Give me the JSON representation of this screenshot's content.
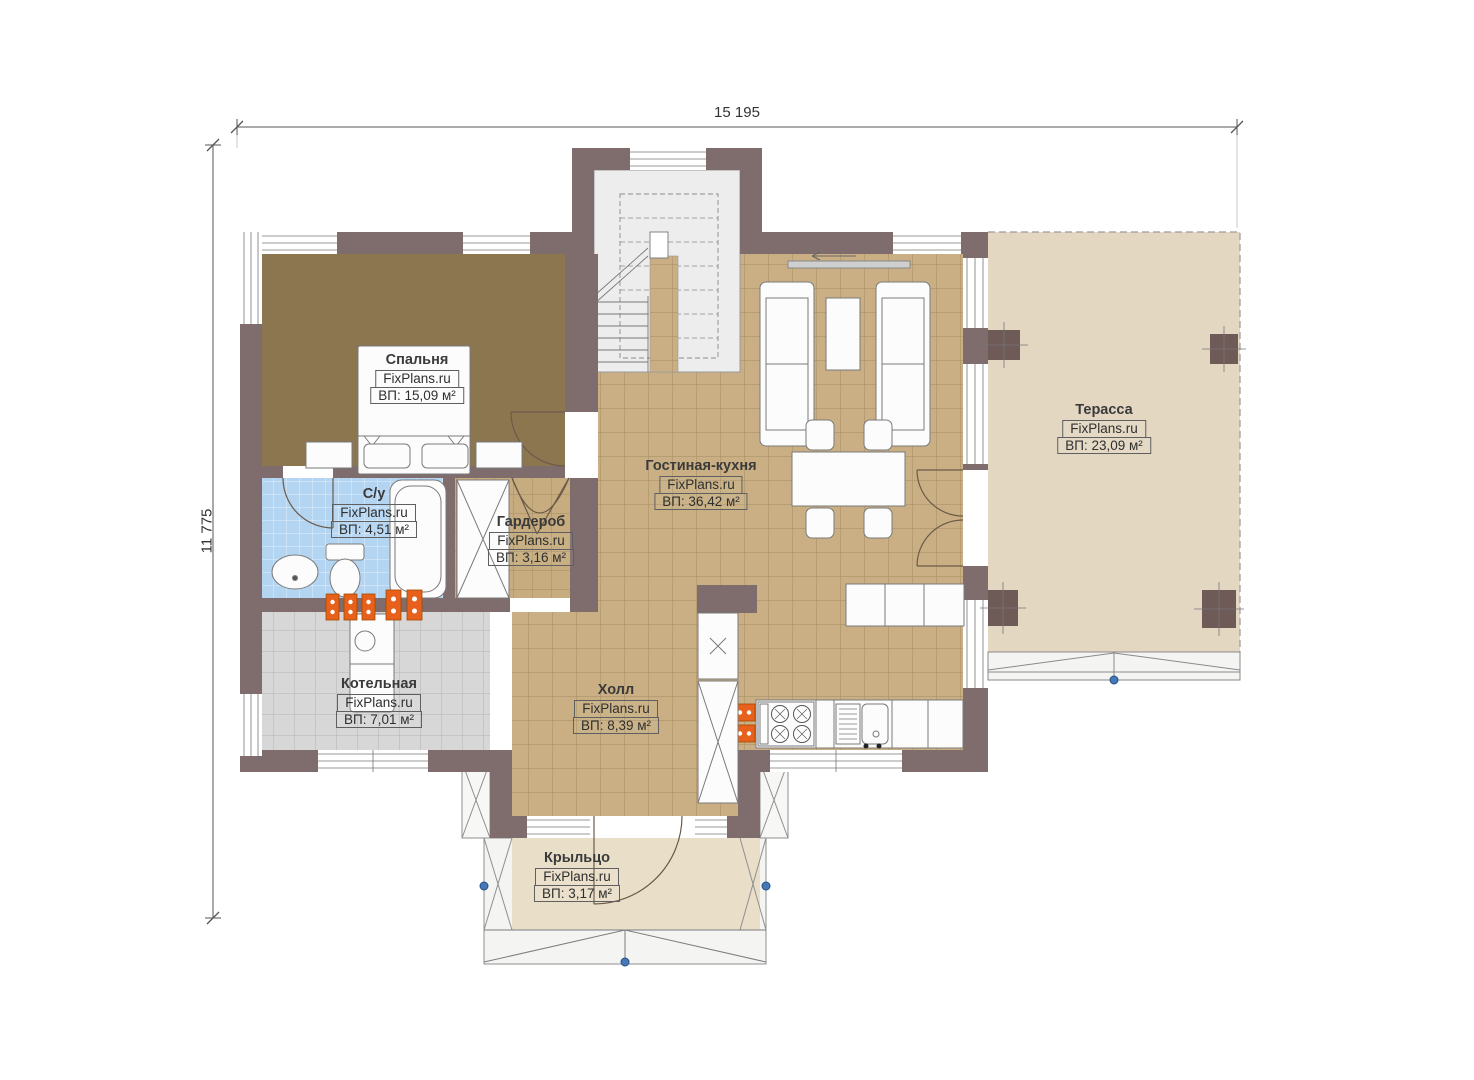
{
  "watermark": "FixPlans.ru",
  "dimensions": {
    "width": "15 195",
    "height": "11 775"
  },
  "rooms": {
    "bedroom": {
      "name": "Спальня",
      "area": "ВП: 15,09 м²"
    },
    "bathroom": {
      "name": "С/у",
      "area": "ВП: 4,51 м²"
    },
    "wardrobe": {
      "name": "Гардероб",
      "area": "ВП: 3,16 м²"
    },
    "living": {
      "name": "Гостиная-кухня",
      "area": "ВП: 36,42 м²"
    },
    "terrace": {
      "name": "Терасса",
      "area": "ВП: 23,09 м²"
    },
    "boiler": {
      "name": "Котельная",
      "area": "ВП: 7,01 м²"
    },
    "hall": {
      "name": "Холл",
      "area": "ВП: 8,39 м²"
    },
    "porch": {
      "name": "Крыльцо",
      "area": "ВП: 3,17 м²"
    }
  },
  "colors": {
    "wall": "#7f6d6d",
    "column": "#6e5a57",
    "bedroom_floor": "#8c7650",
    "living_floor": "#c9af83",
    "terrace_floor": "#e3d7c2",
    "porch_floor": "#e9dfc9",
    "bath_floor": "#b4d5f2",
    "boiler_floor": "#d7d7d7",
    "wardrobe_floor": "#c6ac7e",
    "radiator": "#e8611c",
    "marker_blue": "#4677b6"
  }
}
